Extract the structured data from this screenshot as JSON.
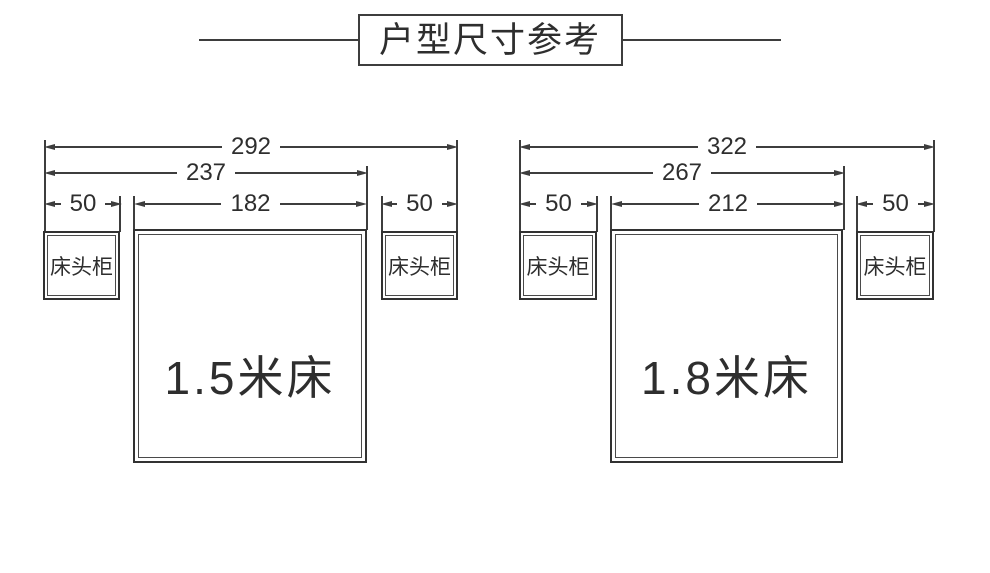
{
  "title": "户型尺寸参考",
  "colors": {
    "line": "#3d3d3d",
    "text": "#2e2e2e",
    "background": "#ffffff"
  },
  "diagrams": [
    {
      "bed_label": "1.5米床",
      "nightstand_left_label": "床头柜",
      "nightstand_right_label": "床头柜",
      "dims": {
        "total": "292",
        "bed_with_left_nightstand": "237",
        "bed_width": "182",
        "nightstand_left_width": "50",
        "nightstand_right_width": "50"
      }
    },
    {
      "bed_label": "1.8米床",
      "nightstand_left_label": "床头柜",
      "nightstand_right_label": "床头柜",
      "dims": {
        "total": "322",
        "bed_with_left_nightstand": "267",
        "bed_width": "212",
        "nightstand_left_width": "50",
        "nightstand_right_width": "50"
      }
    }
  ]
}
